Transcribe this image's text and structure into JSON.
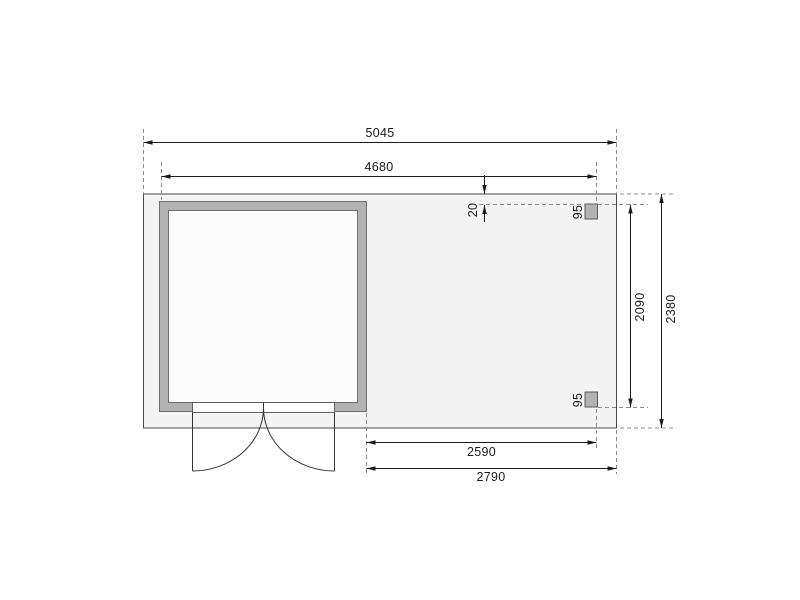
{
  "drawing": {
    "labels": {
      "total_width": "5045",
      "frame_width": "4680",
      "front_offset": "20",
      "post_size_top": "95",
      "post_size_bottom": "95",
      "post_depth_span": "2090",
      "total_depth": "2380",
      "annex_inner_width": "2590",
      "annex_width": "2790"
    },
    "colors": {
      "background": "#ffffff",
      "floor_fill": "#f4f4f4",
      "wall_fill": "#b2b2b2",
      "interior_fill": "#fcfcfc",
      "door_opening_fill": "#ffffff",
      "post_fill": "#b2b2b2",
      "outline": "#6e6e6e",
      "slab_outline": "#4a4a4a",
      "dimension_line": "#1a1a1a",
      "extension_dash": "#8c8c8c"
    }
  }
}
